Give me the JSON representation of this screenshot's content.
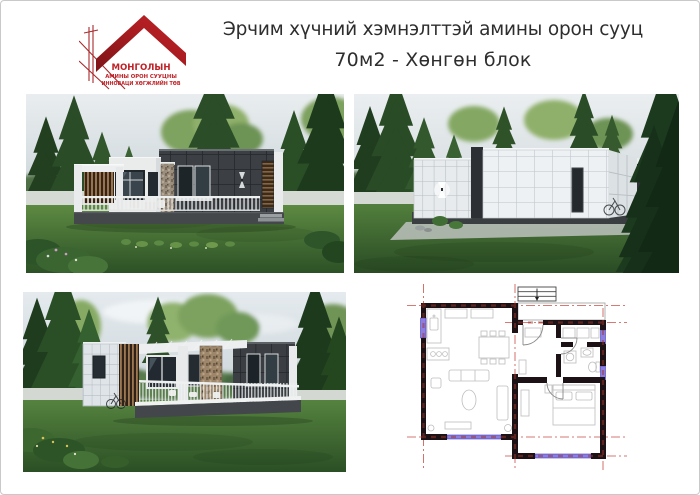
{
  "header": {
    "title": "Эрчим хүчний хэмнэлттэй амины орон сууц",
    "subtitle": "70м2 -  Хөнгөн блок"
  },
  "logo": {
    "line1": "МОНГОЛЫН",
    "line2": "АМИНЫ ОРОН СУУЦНЫ",
    "line3": "ИННОВАЦИ ХӨГЖЛИЙН ТӨВ"
  },
  "colors": {
    "logo_red": "#b02024",
    "title_text": "#2e2e2e",
    "plan_wall": "#1c1216",
    "plan_axis_red": "#c94f46",
    "plan_window": "#8d7ede",
    "lawn_green": "#4e7c3a",
    "house_dark": "#3c4045",
    "house_white": "#e9ebed",
    "sky": "#dde4e8"
  }
}
